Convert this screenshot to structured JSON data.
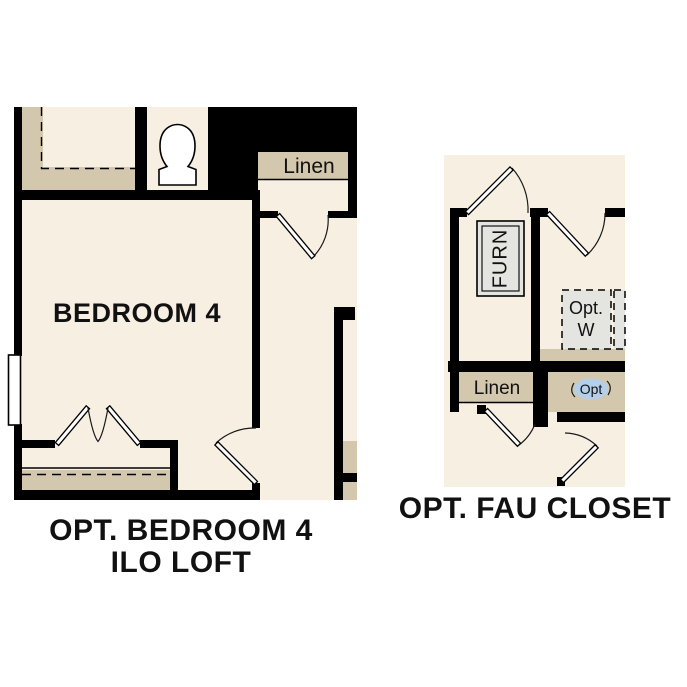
{
  "left_plan": {
    "bedroom_label": "BEDROOM 4",
    "linen_label": "Linen",
    "caption_line1": "OPT. BEDROOM 4",
    "caption_line2": "ILO LOFT"
  },
  "right_plan": {
    "furn_label": "FURN",
    "linen_label": "Linen",
    "opt_washer_line1": "Opt.",
    "opt_washer_line2": "W",
    "opt_marker": "Opt",
    "caption": "OPT. FAU CLOSET"
  },
  "colors": {
    "page_background": "#ffffff",
    "wall": "#000000",
    "floor": "#f7efe2",
    "shelf_tan": "#d3c7ad",
    "fixture_gray": "#e4e4e1",
    "opt_marker_blue": "#b4cfe9",
    "text": "#111111"
  }
}
